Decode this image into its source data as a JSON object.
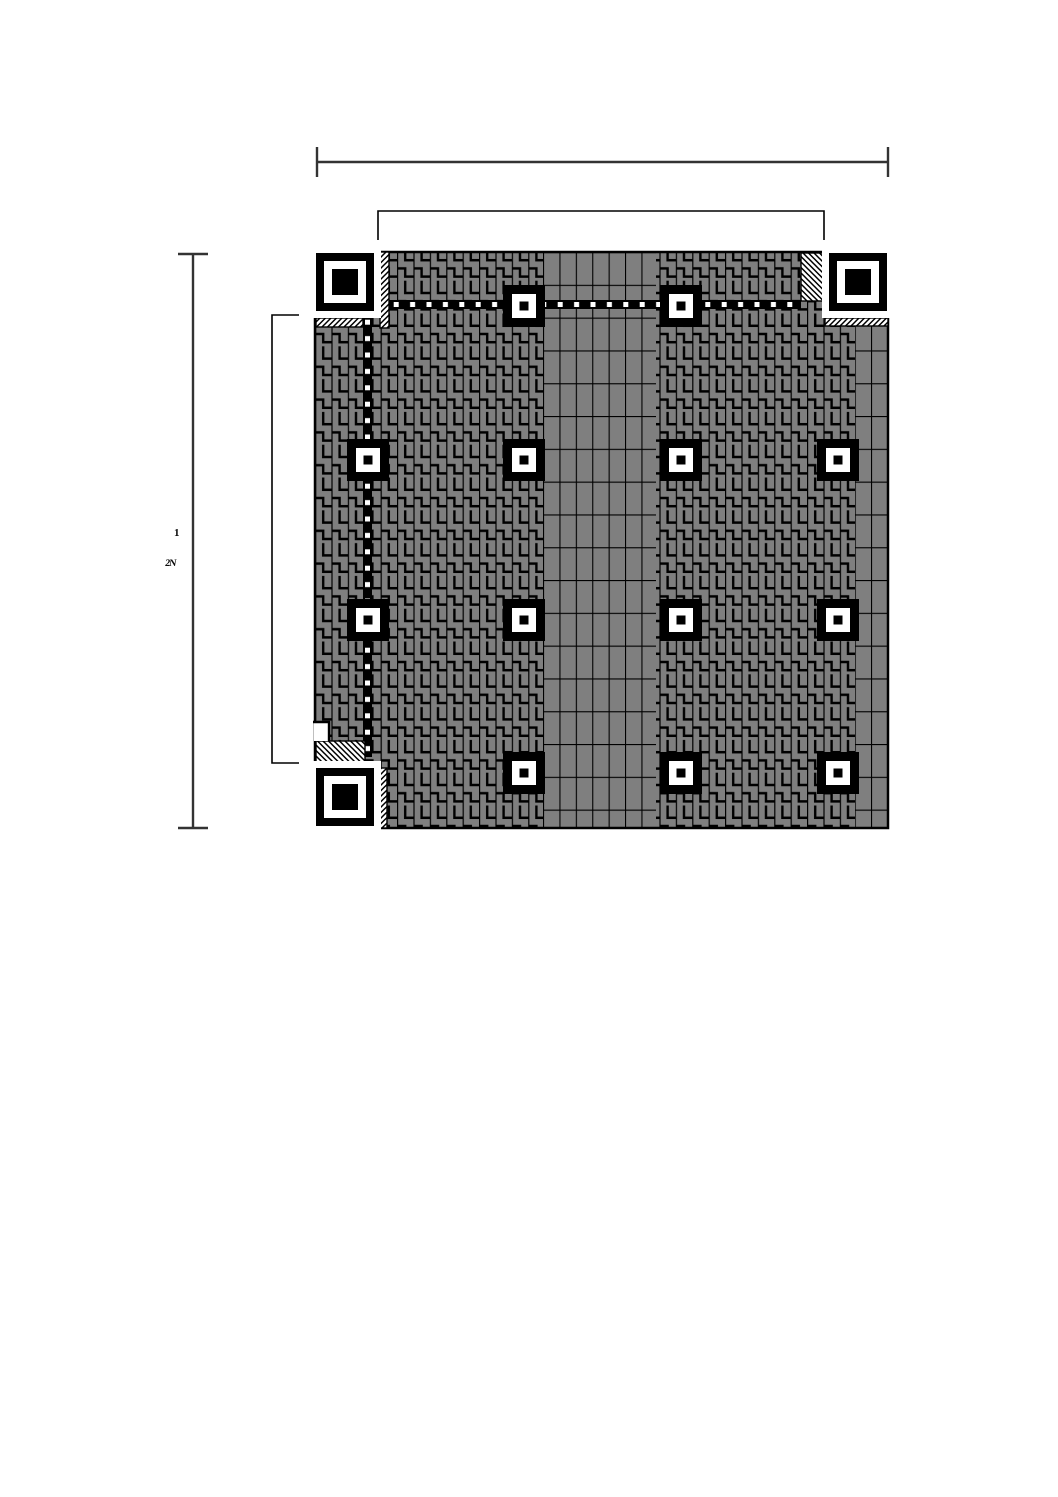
{
  "diagram": {
    "title": "QR code symbol structure diagram",
    "colors": {
      "background": "#ffffff",
      "module_gray": "#7f7f7f",
      "line_black": "#000000",
      "white": "#ffffff",
      "dimension_line": "#333333"
    },
    "module_px": 8.2,
    "symbol": {
      "x": 315,
      "y": 252,
      "w": 573,
      "h": 576
    },
    "side_label": {
      "line1": "1",
      "line2": "2N"
    },
    "finder_style": {
      "outer": 58,
      "ring": 42,
      "core": 26,
      "separator": 7
    },
    "alignment_style": {
      "outer": 42,
      "ring": 24,
      "core": 9
    },
    "finders": [
      {
        "name": "finder-pattern-top-left",
        "x": 316,
        "y": 253
      },
      {
        "name": "finder-pattern-top-right",
        "x": 829,
        "y": 253
      },
      {
        "name": "finder-pattern-bottom-left",
        "x": 316,
        "y": 768
      }
    ],
    "alignment_centers": [
      {
        "cx": 524,
        "cy": 306
      },
      {
        "cx": 681,
        "cy": 306
      },
      {
        "cx": 368,
        "cy": 460
      },
      {
        "cx": 524,
        "cy": 460
      },
      {
        "cx": 681,
        "cy": 460
      },
      {
        "cx": 838,
        "cy": 460
      },
      {
        "cx": 368,
        "cy": 620
      },
      {
        "cx": 524,
        "cy": 620
      },
      {
        "cx": 681,
        "cy": 620
      },
      {
        "cx": 838,
        "cy": 620
      },
      {
        "cx": 524,
        "cy": 773
      },
      {
        "cx": 681,
        "cy": 773
      },
      {
        "cx": 838,
        "cy": 773
      }
    ],
    "brick_bands": [
      {
        "name": "codeword-band-center",
        "x": 543,
        "y": 252,
        "w": 113,
        "h": 576
      },
      {
        "name": "codeword-band-right-edge",
        "x": 855,
        "y": 319,
        "w": 33,
        "h": 509
      }
    ],
    "timing_patterns": {
      "horizontal": {
        "x": 388,
        "y": 300,
        "w": 413,
        "h": 9
      },
      "vertical": {
        "x": 363,
        "y": 314,
        "w": 9,
        "h": 443
      }
    },
    "format_info_areas": [
      {
        "name": "format-info-top-left-vertical",
        "x": 380,
        "y": 252,
        "w": 9,
        "h": 76,
        "hatch": "fwd"
      },
      {
        "name": "format-info-top-left-horizontal",
        "x": 316,
        "y": 318,
        "w": 47,
        "h": 9,
        "hatch": "fwd"
      },
      {
        "name": "format-info-top-right-horizontal",
        "x": 825,
        "y": 318,
        "w": 63,
        "h": 8,
        "hatch": "fwd"
      },
      {
        "name": "format-info-bottom-left-vertical",
        "x": 379,
        "y": 768,
        "w": 8,
        "h": 60,
        "hatch": "fwd"
      }
    ],
    "version_info_areas": [
      {
        "name": "version-info-top-right",
        "x": 801,
        "y": 253,
        "w": 24,
        "h": 48,
        "hatch": "bwd"
      },
      {
        "name": "version-info-bottom-left",
        "x": 316,
        "y": 741,
        "w": 49,
        "h": 21,
        "hatch": "bwd"
      }
    ],
    "white_notch": {
      "x": 314,
      "y": 722,
      "w": 15,
      "h": 19
    },
    "dimension_lines": {
      "top": {
        "x1": 317,
        "x2": 888,
        "y": 162,
        "tick": 30
      },
      "left": {
        "x": 193,
        "y1": 254,
        "y2": 828,
        "tick": 30
      }
    },
    "brackets": {
      "top": {
        "x1": 378,
        "x2": 824,
        "y": 211,
        "drop": 29
      },
      "left": {
        "x": 272,
        "y1": 315,
        "y2": 763,
        "arm": 27
      }
    }
  }
}
